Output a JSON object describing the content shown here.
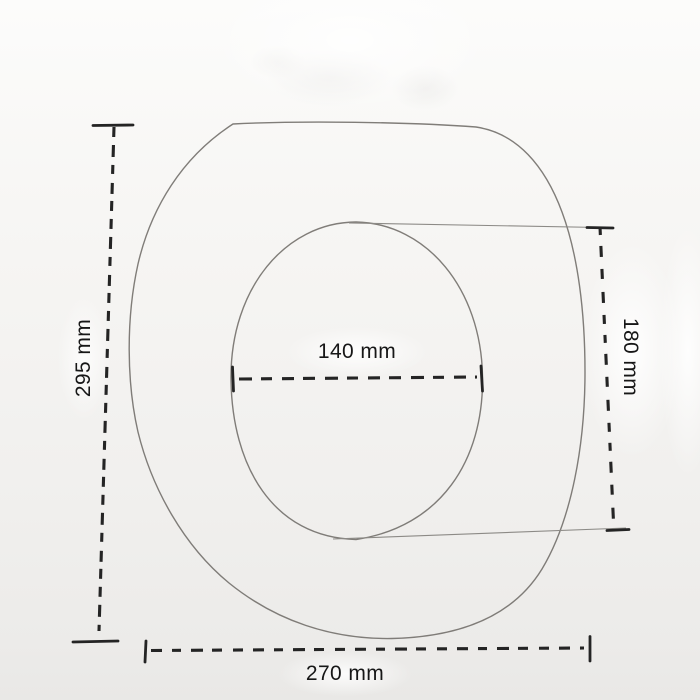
{
  "figure": {
    "type": "technical-dimension-drawing",
    "subject": "toilet seat top view with inner opening (hand-drawn scanned sketch)",
    "unit": "mm",
    "dimensions": {
      "outer_height": {
        "label": "295 mm",
        "value": 295,
        "position": "left",
        "orientation": "vertical"
      },
      "outer_width": {
        "label": "270 mm",
        "value": 270,
        "position": "bottom",
        "orientation": "horizontal"
      },
      "inner_width": {
        "label": "140 mm",
        "value": 140,
        "position": "center",
        "orientation": "horizontal"
      },
      "inner_height": {
        "label": "180 mm",
        "value": 180,
        "position": "right",
        "orientation": "vertical"
      }
    },
    "colors": {
      "background": "#f4f3f1",
      "sketch_line": "#75726e",
      "dimension_line": "#242424",
      "label_text": "#171717"
    }
  }
}
